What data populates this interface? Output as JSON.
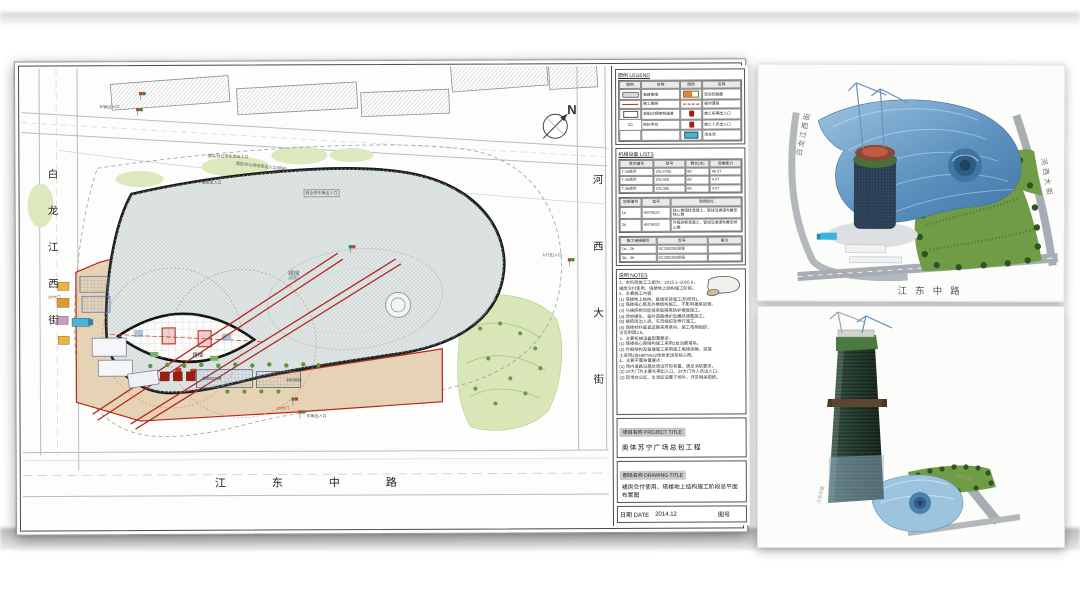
{
  "plan": {
    "compass": "N",
    "streets": {
      "left": "白龙江西街",
      "right": "河西大街",
      "bottom": "江东中路"
    },
    "podium_label": "裙房",
    "podium_sub": "(屋面)",
    "tower_label": "塔楼",
    "annotations": {
      "veh_entrance_top": "车辆出入口",
      "parking_entrance": "酒店/办公停车库出入口",
      "parking_entrance2": "酒店/办公停车库出入口(预留)",
      "podium_entrance": "裙房出入口",
      "commercial_parking": "商业停车库出入口",
      "ped_entrance": "人行出入口",
      "gate1": "1#大门",
      "gate2": "2#大门",
      "veh_entrance_bottom": "车辆出入口",
      "rebar_shed": "钢筋加工棚",
      "material_yard": "材料堆场"
    }
  },
  "titleblock": {
    "legend_title": "图例  LEGEND",
    "legend_headers": [
      "图例",
      "名称",
      "图例",
      "名称"
    ],
    "legend_rows": [
      [
        "临建围墙",
        "现浇砼路面"
      ],
      [
        "施工围挡",
        "临时道路"
      ],
      [
        "装配式钢结构通道",
        "施工车辆出入口"
      ],
      [
        "卸料平台",
        "施工人员出入口"
      ],
      [
        "",
        "洗车池"
      ]
    ],
    "legend_sym_cd": "CD",
    "equip_title": "机械设备  LISTS",
    "crane_table": {
      "headers": [
        "塔吊编号",
        "型号",
        "臂长(米)",
        "起重能力"
      ],
      "rows": [
        [
          "T-1#塔吊",
          "ZSL2700",
          "80",
          "46.3T"
        ],
        [
          "T-2#塔吊",
          "ZSL450",
          "60",
          "4.5T"
        ],
        [
          "T-3#塔吊",
          "ZSL380",
          "60",
          "4.0T"
        ]
      ]
    },
    "pump_table": {
      "headers": [
        "地泵编号",
        "型号",
        "浇筑部位"
      ],
      "rows": [
        [
          "1#",
          "HBT9022",
          "核心筒墙柱混凝土，管线沿通道布置至核心筒"
        ],
        [
          "2#",
          "HBT9022",
          "外框梁板混凝土，管线沿通道布置至核心筒"
        ]
      ]
    },
    "lift_table": {
      "headers": [
        "施工电梯编号",
        "型号",
        "备注"
      ],
      "rows": [
        [
          "1#、2#",
          "SC200/200双笼",
          ""
        ],
        [
          "3#、4#",
          "SC200/200双笼",
          ""
        ]
      ]
    },
    "notes_title": "说明  NOTES",
    "notes_lines": [
      "1、本阶段施工工期为：2015.1~2016.6，",
      "   裙房交付使用，塔楼地上结构施工阶段。",
      "2、主要施工内容：",
      "(1) 塔楼地上结构、幕墙安装施工(阶段性)。",
      "(2) 塔楼核心筒及外框结构施工，不影响裙房运营。",
      "(3) 与裙房相邻区域采取隔离防护措施施工。",
      "(4) 场地硬化、临时道路维护及围挡调整施工。",
      "(5) 裙房周边人流、车流组织及导行施工。",
      "(6) 塔楼材料垂直运输采用塔吊、施工电梯组织，",
      "    详见附图2.6。",
      "3、主要机械设备配置要求：",
      "(1) 塔楼核心筒结构施工采用2台动臂塔吊。",
      "(2) 外框结构及幕墙施工采用施工电梯运输，混凝",
      "    土采用2台HBT9022地泵泵送至核心筒。",
      "4、主要平面布置要点：",
      "(1) 场内道路沿基坑周边环形布置，满足消防要求。",
      "(2) 1#大门为主要车辆出入口，2#大门为人员出入口。",
      "(3) 现场办公区、生活区设置于场外，详见相关图纸。"
    ],
    "project_label": "项目名称 PROJECT TITLE",
    "project_value": "奥体苏宁广场总包工程",
    "drawing_label": "图纸名称 DRAWING TITLE",
    "drawing_value": "裙房交付使用、塔楼地上结构施工阶段总平面布置图",
    "date_label": "日期  DATE",
    "date_value": "2014.12",
    "sheet_no_label": "图号"
  },
  "renders": {
    "top": {
      "street_left": "白龙江西街",
      "street_right": "河西大街",
      "street_bottom": "江东中路"
    },
    "bottom": {
      "label_left": "江东中路",
      "label_right": "河西大街"
    }
  },
  "colors": {
    "fence_red": "#b5281c",
    "podium_fill": "#e2e8e7",
    "construction_beige": "#e3cdb4",
    "render_blue": "#6fa3cc",
    "landscape_green": "#6f9c45"
  }
}
